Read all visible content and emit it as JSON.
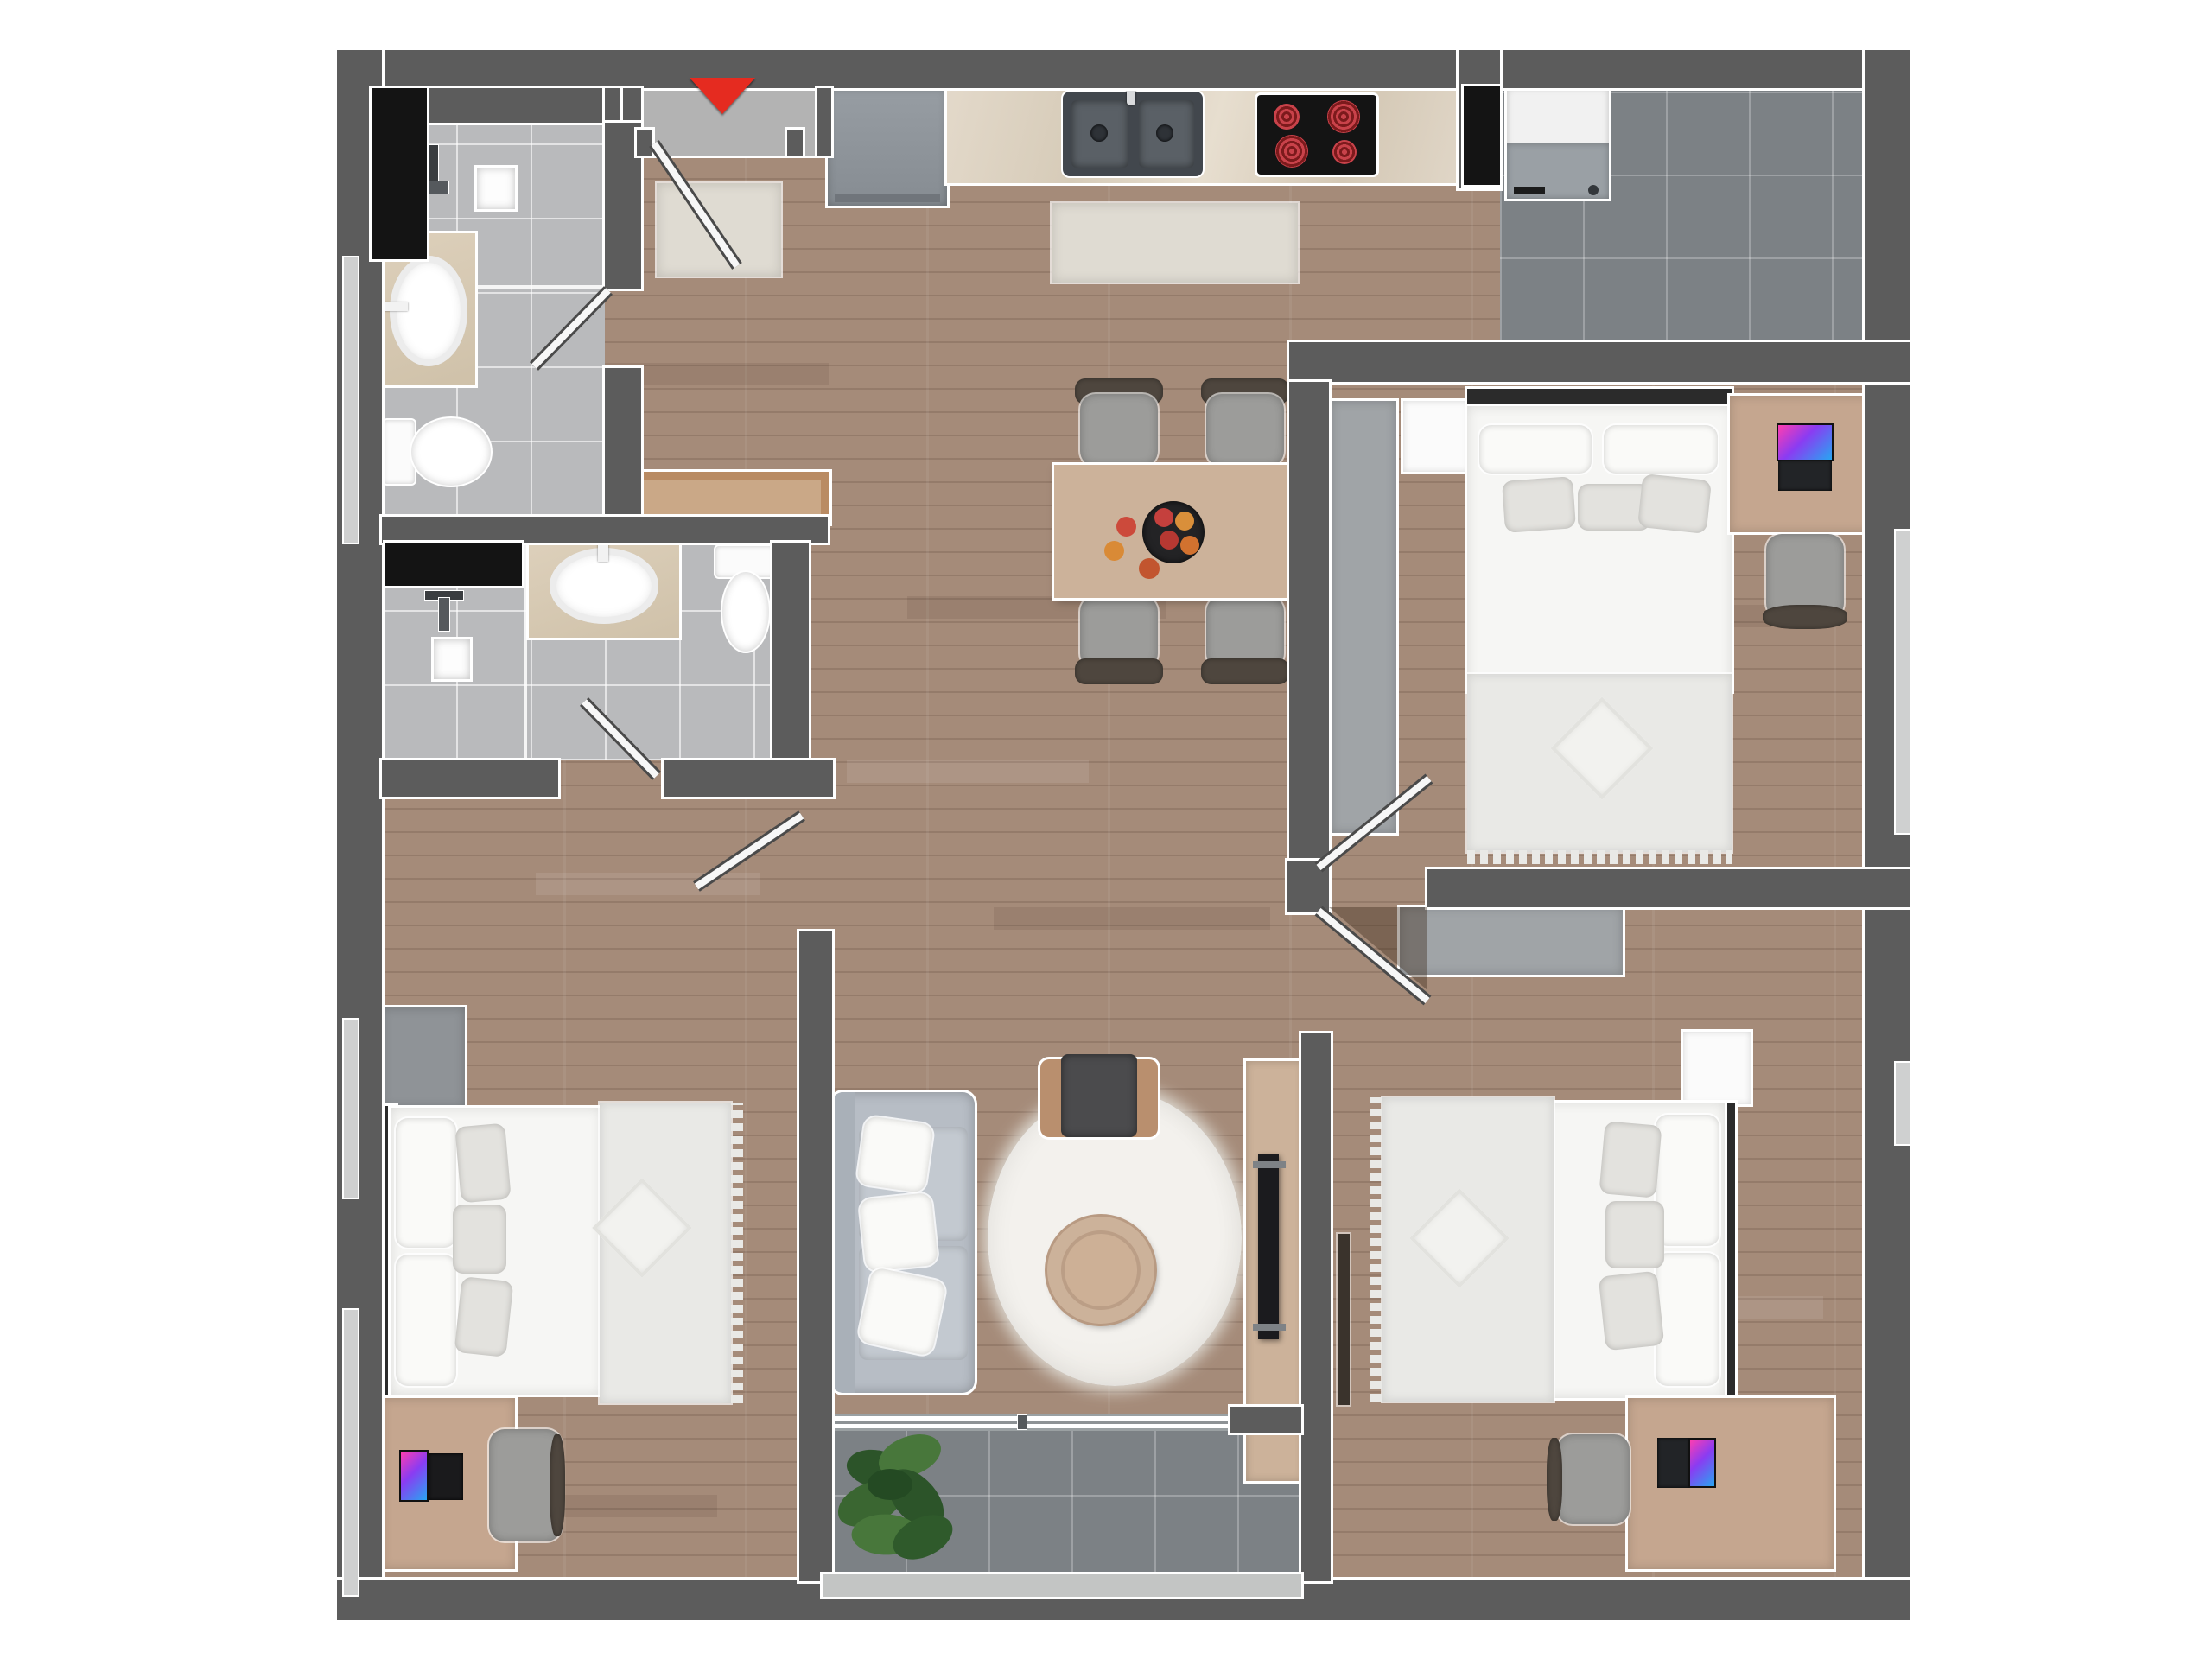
{
  "title": "3-bedroom apartment 3D floor plan, top-down view",
  "palette": {
    "wall": "#5c5c5c",
    "wood": "#a58b79",
    "tileLight": "#b9babc",
    "tileDark": "#7c8185",
    "vestibule": "#b3b3b3",
    "counter": "#ddd3c3",
    "appliance": "#8d9399",
    "black": "#141414",
    "red": "#e52b20",
    "bedWhite": "#f6f6f4",
    "blanket": "#e9e9e6",
    "wardrobe": "#a0a4a7",
    "deskWood": "#c5a68f",
    "chairGray": "#9c9c9a",
    "chairDark": "#4e463e",
    "sofa": "#b7bdc5",
    "shag": "#efede9",
    "woodLight": "#ccb29a",
    "tv": "#1b1b1e",
    "plantDark": "#2c5429",
    "plantLight": "#48773b",
    "rug": "#dfdbd2",
    "windowLight": "#cfd0d0",
    "vanity": "#d9ccb6"
  },
  "entrance": {
    "marker": "red-triangle-down",
    "items": [
      "entry-door",
      "doormat"
    ]
  },
  "rooms": [
    {
      "name": "bathroom-1",
      "floor": "light-gray-tile",
      "items": [
        "wall-niche",
        "shower-fixture",
        "shower-caddy",
        "vanity-sink",
        "toilet",
        "door"
      ]
    },
    {
      "name": "bathroom-2",
      "floor": "light-gray-tile",
      "items": [
        "wall-niche",
        "shower-fixture",
        "shower-caddy",
        "vanity-sink",
        "toilet",
        "door"
      ]
    },
    {
      "name": "kitchen",
      "floor": "wood",
      "items": [
        "under-counter-appliance",
        "marble-countertop",
        "double-sink",
        "cooktop-4-burners",
        "runner-rug"
      ]
    },
    {
      "name": "laundry-room",
      "floor": "dark-gray-tile",
      "items": [
        "wall-niche",
        "washing-machine"
      ]
    },
    {
      "name": "dining-area",
      "floor": "wood",
      "items": [
        "dining-table",
        "chair",
        "chair",
        "chair",
        "chair",
        "fruit-bowl"
      ]
    },
    {
      "name": "master-bedroom",
      "floor": "wood",
      "items": [
        "wardrobe",
        "nightstand",
        "double-bed",
        "desk",
        "laptop",
        "desk-chair",
        "window"
      ]
    },
    {
      "name": "bedroom-2",
      "floor": "wood",
      "items": [
        "wardrobe",
        "double-bed",
        "desk",
        "tablet",
        "desk-pad",
        "desk-chair",
        "windows"
      ]
    },
    {
      "name": "bedroom-3",
      "floor": "wood",
      "items": [
        "wardrobe",
        "nightstand",
        "double-bed",
        "desk",
        "laptop",
        "desk-chair",
        "wall-shelf",
        "window"
      ]
    },
    {
      "name": "living-room",
      "floor": "wood",
      "items": [
        "sofa",
        "round-shag-rug",
        "round-coffee-table",
        "armchair",
        "tv-stand",
        "tv"
      ]
    },
    {
      "name": "balcony",
      "floor": "dark-gray-tile",
      "items": [
        "plant",
        "sliding-door",
        "railing"
      ]
    },
    {
      "name": "hallway",
      "floor": "wood",
      "items": [
        "wood-console"
      ]
    }
  ]
}
